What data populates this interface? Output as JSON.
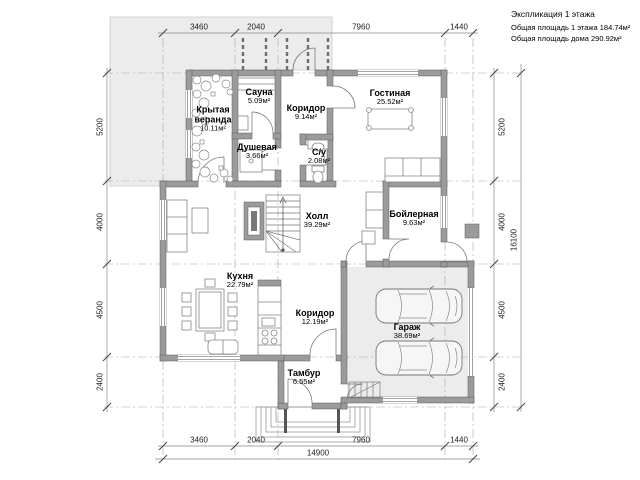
{
  "legend": {
    "title": "Экспликация 1 этажа",
    "area_floor": "Общая площадь 1 этажа 184.74м²",
    "area_house": "Общая площадь дома 290.92м²"
  },
  "rooms": {
    "veranda": {
      "name": "Крытая веранда",
      "area": "10.11м²"
    },
    "sauna": {
      "name": "Сауна",
      "area": "5.09м²"
    },
    "corridor1": {
      "name": "Коридор",
      "area": "9.14м²"
    },
    "living": {
      "name": "Гостиная",
      "area": "25.52м²"
    },
    "shower": {
      "name": "Душевая",
      "area": "3.66м²"
    },
    "wc": {
      "name": "С/у",
      "area": "2.08м²"
    },
    "hall": {
      "name": "Холл",
      "area": "39.29м²"
    },
    "boiler": {
      "name": "Бойлерная",
      "area": "9.63м²"
    },
    "kitchen": {
      "name": "Кухня",
      "area": "22.79м²"
    },
    "corridor2": {
      "name": "Коридор",
      "area": "12.19м²"
    },
    "garage": {
      "name": "Гараж",
      "area": "38.69м²"
    },
    "tambour": {
      "name": "Тамбур",
      "area": "6.55м²"
    }
  },
  "dims": {
    "top": [
      "3460",
      "2040",
      "7960",
      "1440"
    ],
    "bottom": [
      "3460",
      "2040",
      "7960",
      "1440"
    ],
    "total_width": "14900",
    "left": [
      "5200",
      "4000",
      "4500",
      "2400"
    ],
    "right": [
      "5200",
      "4000",
      "4500",
      "2400"
    ],
    "total_height": "16100"
  },
  "colors": {
    "wall": "#9b9b9b",
    "wall_edge": "#5a5a5a",
    "terrace": "#ececec",
    "garage_floor": "#ececec",
    "furniture_line": "#808080",
    "dim_line": "#888888"
  }
}
